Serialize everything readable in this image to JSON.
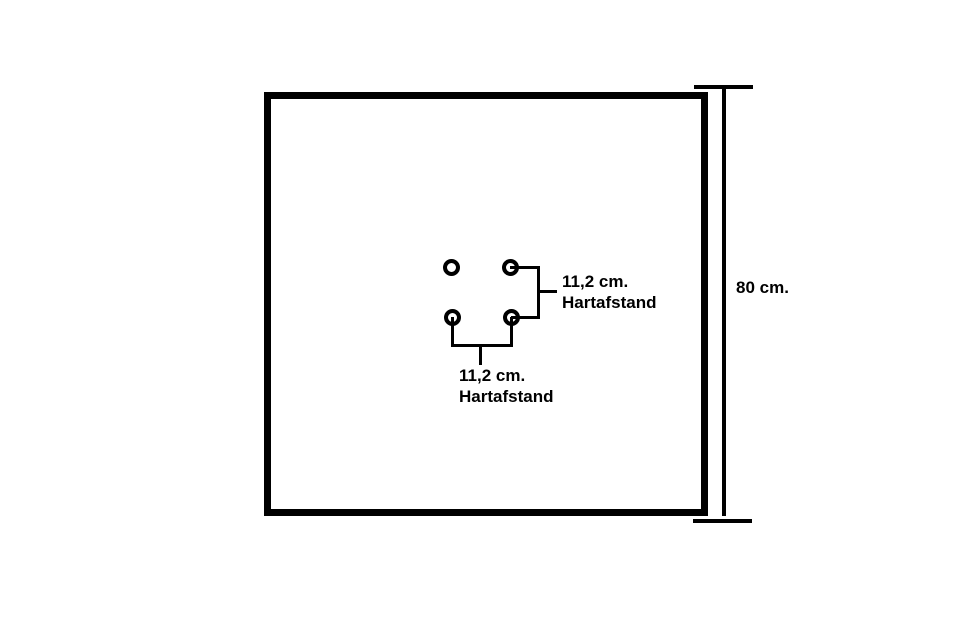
{
  "colors": {
    "ink": "#000000",
    "background": "#ffffff"
  },
  "plate": {
    "height_label": "80 cm."
  },
  "holes": {
    "count": 4
  },
  "spacing_vertical": {
    "value": "11,2 cm.",
    "label": "Hartafstand"
  },
  "spacing_horizontal": {
    "value": "11,2 cm.",
    "label": "Hartafstand"
  }
}
